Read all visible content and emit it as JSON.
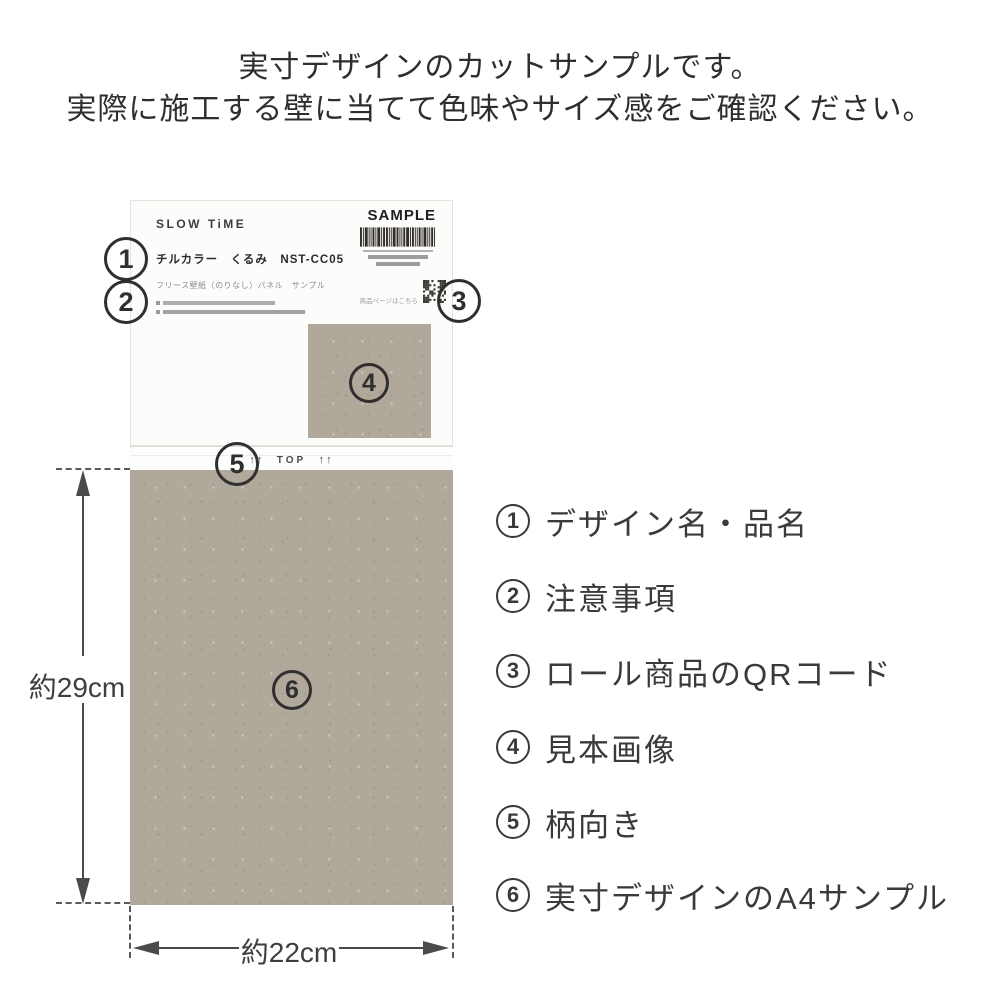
{
  "heading": {
    "line1": "実寸デザインのカットサンプルです。",
    "line2": "実際に施工する壁に当てて色味やサイズ感をご確認ください。"
  },
  "card": {
    "brand": "SLOW TiME",
    "sample_label": "SAMPLE",
    "product_name": "チルカラー　くるみ　NST-CC05",
    "product_sub": "フリース壁紙（のりなし）パネル　サンプル",
    "qr_caption": "商品ページはこちら",
    "direction": {
      "arrows": "↑↑",
      "label": "TOP"
    }
  },
  "callouts": {
    "c1": "1",
    "c2": "2",
    "c3": "3",
    "c4": "4",
    "c5": "5",
    "c6": "6"
  },
  "dimensions": {
    "height": "約29cm",
    "width": "約22cm"
  },
  "legend": {
    "items": [
      {
        "num": "1",
        "label": "デザイン名・品名"
      },
      {
        "num": "2",
        "label": "注意事項"
      },
      {
        "num": "3",
        "label": "ロール商品のQRコード"
      },
      {
        "num": "4",
        "label": "見本画像"
      },
      {
        "num": "5",
        "label": "柄向き"
      },
      {
        "num": "6",
        "label": "実寸デザインのA4サンプル"
      }
    ]
  },
  "colors": {
    "sample_swatch": "#b1a89c",
    "text": "#3a3a3a"
  }
}
